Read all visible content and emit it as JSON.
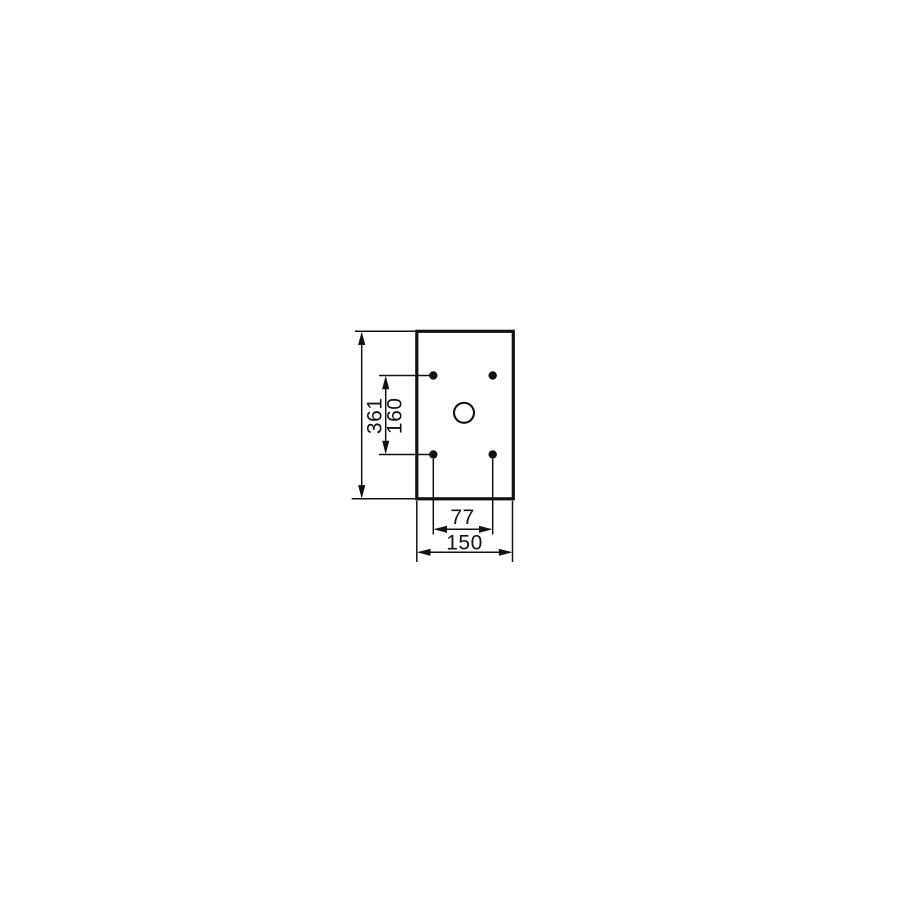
{
  "drawing": {
    "kind": "technical-dimension-drawing",
    "part": "rectangular mounting plate with four holes and one center hole",
    "dimensions": {
      "overall_height": {
        "label": "361"
      },
      "hole_pitch_vertical": {
        "label": "160"
      },
      "hole_pitch_horizontal": {
        "label": "77"
      },
      "overall_width": {
        "label": "150"
      }
    },
    "colors": {
      "line": "#121212",
      "background": "#ffffff"
    }
  }
}
